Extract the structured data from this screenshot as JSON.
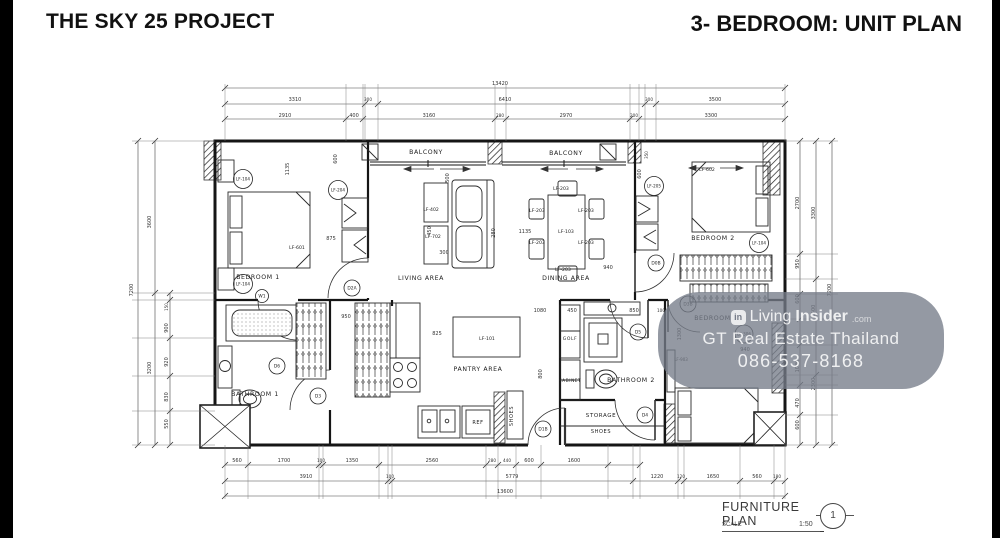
{
  "header": {
    "left_title": "THE SKY 25 PROJECT",
    "right_title": "3- BEDROOM: UNIT PLAN"
  },
  "watermark": {
    "logo_text": "in",
    "brand_prefix": "Living",
    "brand_bold": "Insider",
    "brand_suffix": ".com",
    "line2": "GT Real Estate Thailand",
    "line3": "086-537-8168"
  },
  "title_block": {
    "name": "FURNITURE PLAN",
    "scale_label": "SCALE",
    "scale_value": "1:50",
    "detail_number": "1"
  },
  "plan": {
    "room_labels": [
      {
        "t": "BALCONY",
        "x": 426,
        "y": 154
      },
      {
        "t": "BALCONY",
        "x": 566,
        "y": 155
      },
      {
        "t": "BEDROOM 1",
        "x": 258,
        "y": 279
      },
      {
        "t": "LIVING AREA",
        "x": 421,
        "y": 280
      },
      {
        "t": "DINING AREA",
        "x": 566,
        "y": 280
      },
      {
        "t": "BEDROOM 2",
        "x": 713,
        "y": 240
      },
      {
        "t": "BATHROOM 1",
        "x": 255,
        "y": 396
      },
      {
        "t": "PANTRY AREA",
        "x": 478,
        "y": 371
      },
      {
        "t": "BATHROOM 2",
        "x": 631,
        "y": 382
      },
      {
        "t": "BEDROOM 3",
        "x": 716,
        "y": 320
      },
      {
        "t": "STORAGE",
        "x": 601,
        "y": 417,
        "s": 5.5
      },
      {
        "t": "SHOES",
        "x": 601,
        "y": 433,
        "s": 5
      },
      {
        "t": "SHOES",
        "x": 513,
        "y": 416,
        "s": 5,
        "rot": -90
      },
      {
        "t": "REF",
        "x": 478,
        "y": 424,
        "s": 5
      },
      {
        "t": "GOLF",
        "x": 570,
        "y": 340,
        "s": 4.5
      },
      {
        "t": "CABINET",
        "x": 570,
        "y": 382,
        "s": 4.2
      }
    ],
    "furniture_tags": [
      {
        "t": "LF-601",
        "x": 297,
        "y": 249
      },
      {
        "t": "LF-602",
        "x": 707,
        "y": 171
      },
      {
        "t": "LF-103",
        "x": 566,
        "y": 233
      },
      {
        "t": "LF-101",
        "x": 487,
        "y": 340
      },
      {
        "t": "LF-402",
        "x": 431,
        "y": 211
      },
      {
        "t": "LF-702",
        "x": 433,
        "y": 238
      },
      {
        "t": "LF-203",
        "x": 561,
        "y": 190
      },
      {
        "t": "LF-203",
        "x": 537,
        "y": 212
      },
      {
        "t": "LF-203",
        "x": 586,
        "y": 212
      },
      {
        "t": "LF-203",
        "x": 537,
        "y": 244
      },
      {
        "t": "LF-203",
        "x": 586,
        "y": 244
      },
      {
        "t": "LF-203",
        "x": 563,
        "y": 271
      },
      {
        "t": "LF-903",
        "x": 681,
        "y": 361,
        "s": 4
      }
    ],
    "circle_tags": [
      {
        "t": "LF-104",
        "x": 243,
        "y": 179
      },
      {
        "t": "LF-104",
        "x": 243,
        "y": 284
      },
      {
        "t": "LF-204",
        "x": 338,
        "y": 190
      },
      {
        "t": "LF-205",
        "x": 654,
        "y": 186
      },
      {
        "t": "LF-104",
        "x": 759,
        "y": 243
      },
      {
        "t": "LF-306",
        "x": 744,
        "y": 334,
        "r": 9
      }
    ],
    "door_tags": [
      {
        "t": "D2A",
        "x": 352,
        "y": 288
      },
      {
        "t": "D0B",
        "x": 656,
        "y": 263
      },
      {
        "t": "D3B",
        "x": 688,
        "y": 304
      },
      {
        "t": "D1B",
        "x": 543,
        "y": 429
      },
      {
        "t": "D5",
        "x": 638,
        "y": 332
      },
      {
        "t": "D4",
        "x": 645,
        "y": 415
      },
      {
        "t": "D6",
        "x": 277,
        "y": 366
      },
      {
        "t": "D3",
        "x": 318,
        "y": 396
      },
      {
        "t": "W1",
        "x": 262,
        "y": 296,
        "r": 6.5
      }
    ],
    "dim_labels": [
      {
        "t": "13420",
        "x": 500,
        "y": 85
      },
      {
        "t": "3310",
        "x": 295,
        "y": 101
      },
      {
        "t": "300",
        "x": 368,
        "y": 101,
        "s": 4.2
      },
      {
        "t": "6410",
        "x": 505,
        "y": 101
      },
      {
        "t": "300",
        "x": 649,
        "y": 101,
        "s": 4.2
      },
      {
        "t": "3500",
        "x": 715,
        "y": 101
      },
      {
        "t": "2910",
        "x": 285,
        "y": 117
      },
      {
        "t": "400",
        "x": 354,
        "y": 117
      },
      {
        "t": "3160",
        "x": 429,
        "y": 117
      },
      {
        "t": "280",
        "x": 500,
        "y": 117,
        "s": 4.2
      },
      {
        "t": "2970",
        "x": 566,
        "y": 117
      },
      {
        "t": "200",
        "x": 634,
        "y": 117,
        "s": 4.2
      },
      {
        "t": "3300",
        "x": 711,
        "y": 117
      },
      {
        "t": "560",
        "x": 237,
        "y": 462
      },
      {
        "t": "1700",
        "x": 284,
        "y": 462
      },
      {
        "t": "100",
        "x": 321,
        "y": 462,
        "s": 4.2
      },
      {
        "t": "1350",
        "x": 352,
        "y": 462
      },
      {
        "t": "2560",
        "x": 432,
        "y": 462
      },
      {
        "t": "280",
        "x": 492,
        "y": 462,
        "s": 4.2
      },
      {
        "t": "440",
        "x": 507,
        "y": 462,
        "s": 4.2
      },
      {
        "t": "600",
        "x": 529,
        "y": 462
      },
      {
        "t": "1600",
        "x": 574,
        "y": 462
      },
      {
        "t": "3910",
        "x": 306,
        "y": 478
      },
      {
        "t": "100",
        "x": 390,
        "y": 478,
        "s": 4.2
      },
      {
        "t": "5779",
        "x": 512,
        "y": 478
      },
      {
        "t": "1220",
        "x": 657,
        "y": 478
      },
      {
        "t": "120",
        "x": 681,
        "y": 478,
        "s": 4.2
      },
      {
        "t": "1650",
        "x": 713,
        "y": 478
      },
      {
        "t": "560",
        "x": 757,
        "y": 478
      },
      {
        "t": "180",
        "x": 777,
        "y": 478,
        "s": 4.2
      },
      {
        "t": "13600",
        "x": 505,
        "y": 493
      },
      {
        "t": "7200",
        "x": 133,
        "y": 290,
        "rot": -90
      },
      {
        "t": "3600",
        "x": 151,
        "y": 222,
        "rot": -90
      },
      {
        "t": "3200",
        "x": 151,
        "y": 368,
        "rot": -90
      },
      {
        "t": "150",
        "x": 168,
        "y": 307,
        "rot": -90,
        "s": 4
      },
      {
        "t": "900",
        "x": 168,
        "y": 328,
        "rot": -90
      },
      {
        "t": "920",
        "x": 168,
        "y": 362,
        "rot": -90
      },
      {
        "t": "830",
        "x": 168,
        "y": 397,
        "rot": -90
      },
      {
        "t": "550",
        "x": 168,
        "y": 424,
        "rot": -90
      },
      {
        "t": "2700",
        "x": 799,
        "y": 203,
        "rot": -90
      },
      {
        "t": "950",
        "x": 799,
        "y": 264,
        "rot": -90
      },
      {
        "t": "600",
        "x": 799,
        "y": 299,
        "rot": -90
      },
      {
        "t": "1030",
        "x": 799,
        "y": 366,
        "rot": -90
      },
      {
        "t": "470",
        "x": 799,
        "y": 403,
        "rot": -90
      },
      {
        "t": "600",
        "x": 799,
        "y": 425,
        "rot": -90
      },
      {
        "t": "3300",
        "x": 815,
        "y": 213,
        "rot": -90
      },
      {
        "t": "1500",
        "x": 815,
        "y": 311,
        "rot": -90
      },
      {
        "t": "2300",
        "x": 815,
        "y": 384,
        "rot": -90
      },
      {
        "t": "7200",
        "x": 831,
        "y": 290,
        "rot": -90
      },
      {
        "t": "1135",
        "x": 289,
        "y": 169,
        "rot": -90
      },
      {
        "t": "600",
        "x": 337,
        "y": 159,
        "rot": -90
      },
      {
        "t": "875",
        "x": 331,
        "y": 240
      },
      {
        "t": "500",
        "x": 449,
        "y": 178,
        "rot": -90
      },
      {
        "t": "450",
        "x": 431,
        "y": 231,
        "rot": -90
      },
      {
        "t": "300",
        "x": 444,
        "y": 254
      },
      {
        "t": "280",
        "x": 495,
        "y": 233,
        "rot": -90
      },
      {
        "t": "1135",
        "x": 525,
        "y": 233
      },
      {
        "t": "940",
        "x": 608,
        "y": 269
      },
      {
        "t": "350",
        "x": 648,
        "y": 155,
        "rot": -90,
        "s": 4
      },
      {
        "t": "600",
        "x": 641,
        "y": 174,
        "rot": -90
      },
      {
        "t": "950",
        "x": 346,
        "y": 318
      },
      {
        "t": "825",
        "x": 437,
        "y": 335
      },
      {
        "t": "1080",
        "x": 540,
        "y": 312
      },
      {
        "t": "450",
        "x": 572,
        "y": 312
      },
      {
        "t": "850",
        "x": 634,
        "y": 312
      },
      {
        "t": "100",
        "x": 661,
        "y": 312,
        "s": 4.2
      },
      {
        "t": "800",
        "x": 542,
        "y": 374,
        "rot": -90
      },
      {
        "t": "1300",
        "x": 681,
        "y": 334,
        "rot": -90
      },
      {
        "t": "940",
        "x": 745,
        "y": 351
      }
    ]
  }
}
